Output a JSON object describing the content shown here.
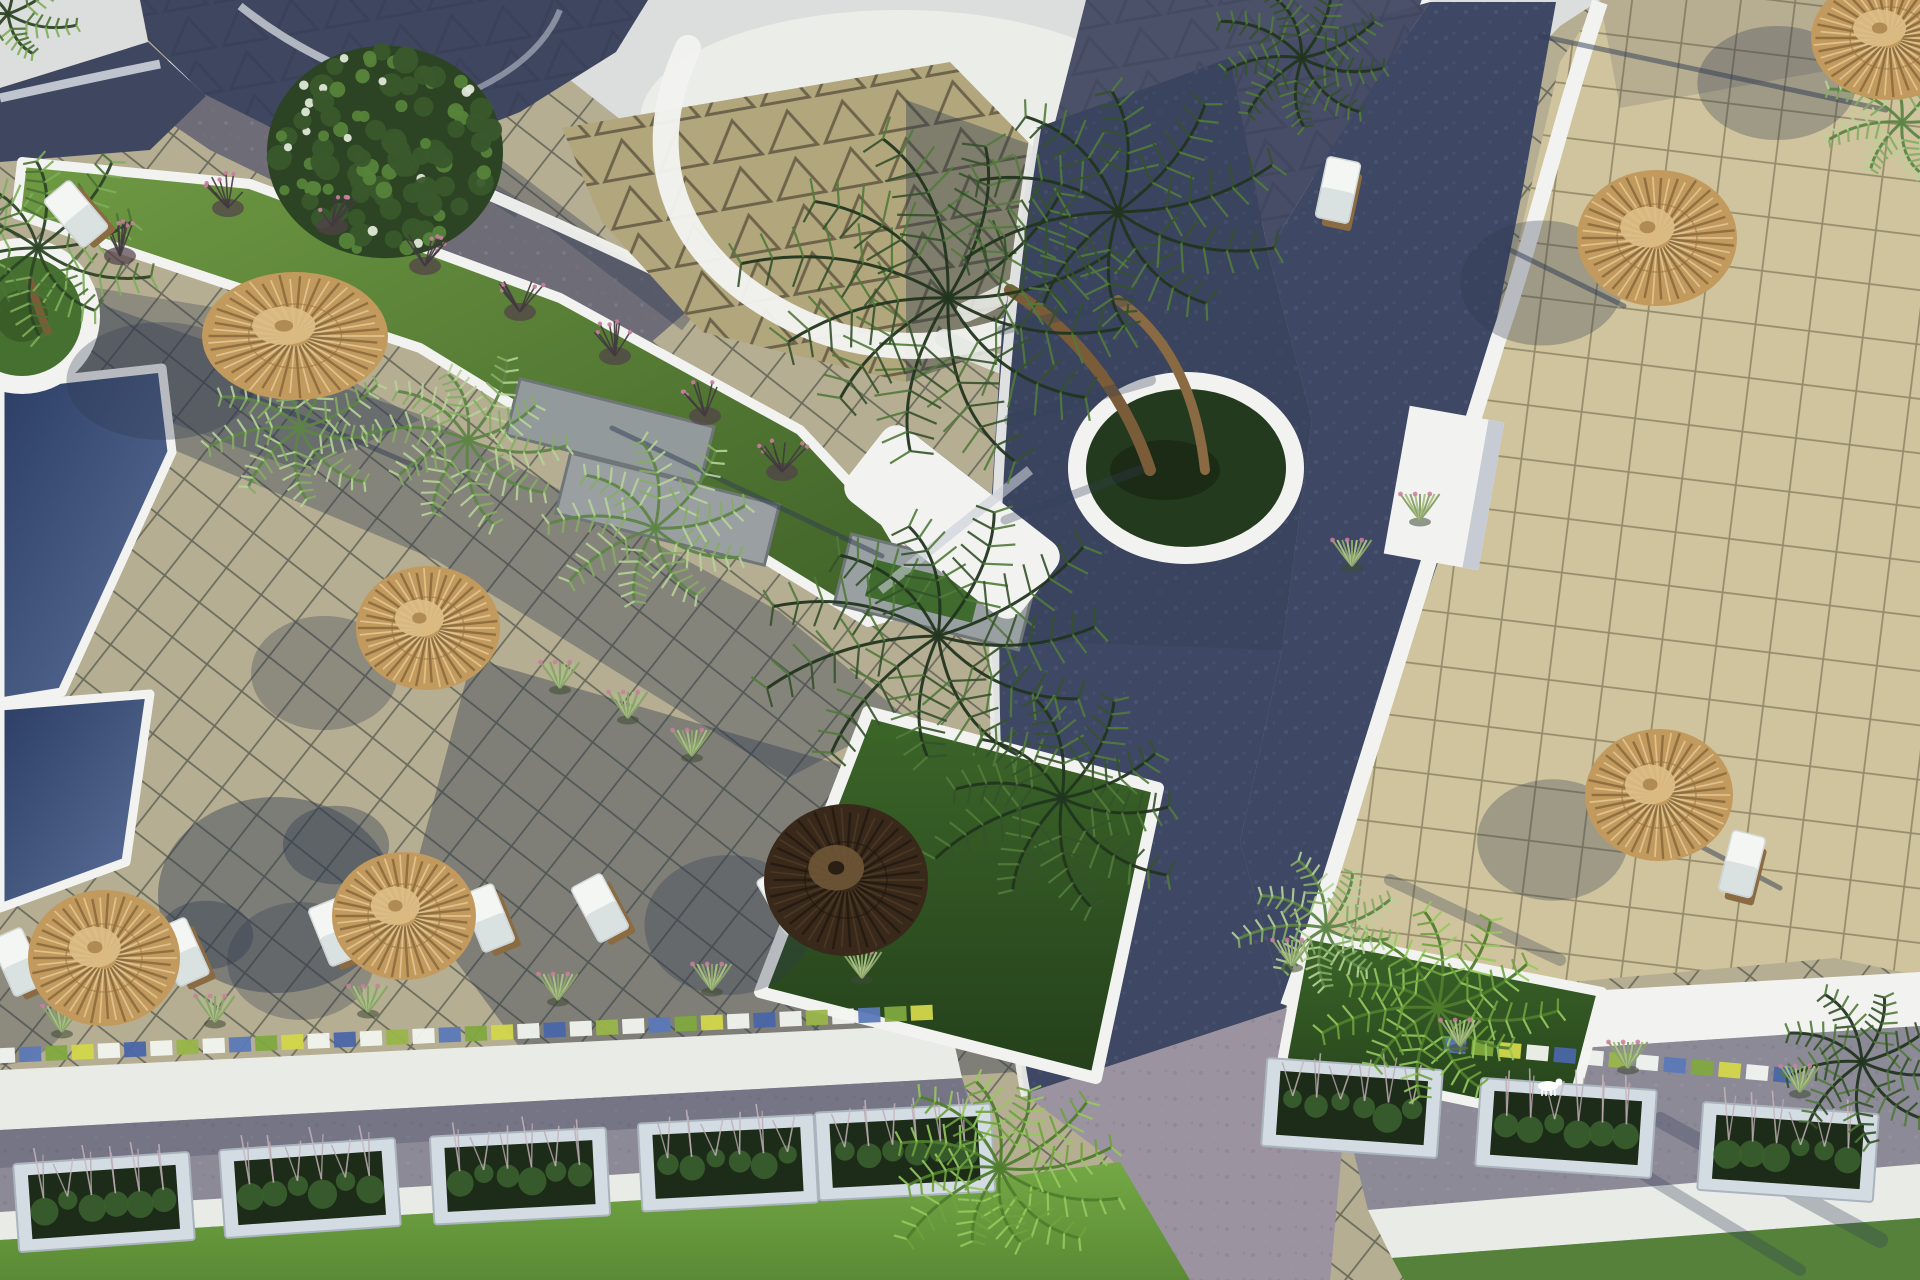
{
  "meta": {
    "description": "Top-down aerial 3D architectural rendering of a resort complex: tiled pool terraces with thatched parasols and white sun loungers, dark-blue swimming pools, cobbled pathways, curved white walls, grass planters with palm trees, and flower boxes along a lower promenade.",
    "view": "top-down aerial",
    "style": "photorealistic 3D render, afternoon sun casting long shadows to the lower-left"
  },
  "palette": {
    "beige_left": "#b6ae92",
    "grout_left": "#50544a",
    "beige_right": "#cfc49d",
    "grout_right": "#7d7557",
    "tri_tan": "#b2a67c",
    "tri_line": "#4e4533",
    "white": "#f2f3f0",
    "curb_white": "#e9ebe6",
    "off_white": "#e6e8e4",
    "sky_white": "#dcdedd",
    "roof_navy": "#3f4660",
    "roof_navy2": "#4a5168",
    "path_gray": "#6e6d77",
    "road": "#3e4864",
    "road_light": "#9b93a0",
    "cobble": "#8d8a97",
    "stone": "#939a9c",
    "stone_dark": "#6f7678",
    "shadow": "#2e3950",
    "grass_window": "#3f6b2e",
    "frame_light": "#d3dbe3",
    "box_green": "#1d2c18",
    "umbrella_thatch": "#c29a5e",
    "umbrella_thatch_light": "#ddbd85",
    "umbrella_spoke_dark": "#8a6a3c",
    "umbrella_spoke_light": "#e4c894",
    "umbrella_dark": "#39291b",
    "umbrella_dark_cap": "#6e5636",
    "trunk": "#7a5c38",
    "pink": "#c97f9d"
  },
  "scene": {
    "umbrellas": [
      {
        "cx": 295,
        "cy": 336,
        "rx": 93,
        "ry": 64,
        "kind": "thatch"
      },
      {
        "cx": 428,
        "cy": 628,
        "rx": 72,
        "ry": 62,
        "kind": "thatch"
      },
      {
        "cx": 104,
        "cy": 958,
        "rx": 76,
        "ry": 68,
        "kind": "thatch"
      },
      {
        "cx": 404,
        "cy": 916,
        "rx": 72,
        "ry": 64,
        "kind": "thatch"
      },
      {
        "cx": 846,
        "cy": 880,
        "rx": 82,
        "ry": 76,
        "kind": "dark"
      },
      {
        "cx": 1657,
        "cy": 238,
        "rx": 80,
        "ry": 68,
        "kind": "thatch"
      },
      {
        "cx": 1659,
        "cy": 795,
        "rx": 74,
        "ry": 66,
        "kind": "thatch"
      },
      {
        "cx": 1889,
        "cy": 38,
        "rx": 78,
        "ry": 62,
        "kind": "thatch"
      }
    ],
    "loungers": [
      {
        "cx": 18,
        "cy": 962,
        "rot": -24
      },
      {
        "cx": 182,
        "cy": 952,
        "rot": -24
      },
      {
        "cx": 335,
        "cy": 932,
        "rot": -22
      },
      {
        "cx": 488,
        "cy": 918,
        "rot": -22
      },
      {
        "cx": 600,
        "cy": 908,
        "rot": -28
      },
      {
        "cx": 786,
        "cy": 900,
        "rot": -30
      },
      {
        "cx": 1742,
        "cy": 864,
        "rot": 14
      },
      {
        "cx": 1338,
        "cy": 190,
        "rot": 12
      },
      {
        "cx": 76,
        "cy": 214,
        "rot": -40
      }
    ],
    "pools": [
      {
        "name": "pool-left-upper",
        "points": "0,386 162,368 172,452 62,692 0,702",
        "fill": "dark"
      },
      {
        "name": "pool-left-lower",
        "points": "0,706 150,694 126,862 0,908",
        "fill": "dark"
      },
      {
        "name": "pool-right-upper",
        "points": "1856,206 1920,194 1920,482 1868,482 1842,330",
        "fill": "light"
      },
      {
        "name": "pool-right-lower",
        "points": "1776,560 1920,546 1920,758 1806,734 1766,642",
        "fill": "dark"
      }
    ],
    "palms": [
      {
        "cx": 8,
        "cy": 14,
        "r": 72,
        "tone": "mixed",
        "fronds": 7,
        "rot": 0.2
      },
      {
        "cx": 38,
        "cy": 248,
        "r": 130,
        "tone": "mixed",
        "fronds": 10,
        "rot": 0.3
      },
      {
        "cx": 300,
        "cy": 428,
        "r": 95,
        "tone": "fern",
        "fronds": 9,
        "rot": 0.1
      },
      {
        "cx": 468,
        "cy": 440,
        "r": 105,
        "tone": "fern",
        "fronds": 10,
        "rot": 0.7
      },
      {
        "cx": 655,
        "cy": 528,
        "r": 110,
        "tone": "fern",
        "fronds": 9,
        "rot": 0.4
      },
      {
        "cx": 948,
        "cy": 298,
        "r": 225,
        "tone": "dark",
        "fronds": 12,
        "rot": 0.2
      },
      {
        "cx": 1118,
        "cy": 212,
        "r": 165,
        "tone": "dark",
        "fronds": 10,
        "rot": 0.9
      },
      {
        "cx": 938,
        "cy": 636,
        "r": 185,
        "tone": "dark",
        "fronds": 11,
        "rot": 0.5
      },
      {
        "cx": 1062,
        "cy": 798,
        "r": 145,
        "tone": "dark",
        "fronds": 10,
        "rot": 0.1
      },
      {
        "cx": 1000,
        "cy": 1168,
        "r": 125,
        "tone": "bright",
        "fronds": 12,
        "rot": 0.3
      },
      {
        "cx": 1438,
        "cy": 1008,
        "r": 118,
        "tone": "bright",
        "fronds": 11,
        "rot": 0.6
      },
      {
        "cx": 1326,
        "cy": 928,
        "r": 88,
        "tone": "fern",
        "fronds": 9,
        "rot": 0.2
      },
      {
        "cx": 1862,
        "cy": 1062,
        "r": 100,
        "tone": "dark",
        "fronds": 9,
        "rot": 0.8
      },
      {
        "cx": 1902,
        "cy": 122,
        "r": 85,
        "tone": "fern",
        "fronds": 8,
        "rot": 0.5
      },
      {
        "cx": 1302,
        "cy": 58,
        "r": 95,
        "tone": "dark",
        "fronds": 9,
        "rot": 0.15
      }
    ],
    "tree": {
      "cx": 385,
      "cy": 152,
      "r": 118
    },
    "tree_shadow": {
      "cx": 276,
      "cy": 895,
      "rx": 118,
      "ry": 98
    },
    "shrubs": [
      {
        "x": 332,
        "y": 222
      },
      {
        "x": 425,
        "y": 262
      },
      {
        "x": 520,
        "y": 308
      },
      {
        "x": 615,
        "y": 352
      },
      {
        "x": 705,
        "y": 412
      },
      {
        "x": 782,
        "y": 468
      },
      {
        "x": 120,
        "y": 252
      },
      {
        "x": 228,
        "y": 204
      }
    ],
    "tufts": [
      {
        "x": 62,
        "y": 1032
      },
      {
        "x": 215,
        "y": 1022
      },
      {
        "x": 368,
        "y": 1012
      },
      {
        "x": 558,
        "y": 1000
      },
      {
        "x": 712,
        "y": 990
      },
      {
        "x": 862,
        "y": 978
      },
      {
        "x": 628,
        "y": 718
      },
      {
        "x": 560,
        "y": 688
      },
      {
        "x": 692,
        "y": 756
      },
      {
        "x": 1292,
        "y": 966
      },
      {
        "x": 1460,
        "y": 1046
      },
      {
        "x": 1628,
        "y": 1068
      },
      {
        "x": 1800,
        "y": 1092
      },
      {
        "x": 1352,
        "y": 566
      },
      {
        "x": 1420,
        "y": 520
      }
    ],
    "pole_shadows": [
      {
        "x1": 1540,
        "y1": 36,
        "x2": 1886,
        "y2": 110
      },
      {
        "x1": 1506,
        "y1": 248,
        "x2": 1624,
        "y2": 306
      },
      {
        "x1": 612,
        "y1": 428,
        "x2": 882,
        "y2": 556
      },
      {
        "x1": 242,
        "y1": 392,
        "x2": 420,
        "y2": 468
      },
      {
        "x1": 1700,
        "y1": 846,
        "x2": 1780,
        "y2": 888
      }
    ],
    "frond_shadows": [
      {
        "x1": 1002,
        "y1": 330,
        "x2": 1130,
        "y2": 300,
        "w": 10
      },
      {
        "x1": 1010,
        "y1": 420,
        "x2": 1150,
        "y2": 380,
        "w": 12
      },
      {
        "x1": 1005,
        "y1": 520,
        "x2": 1140,
        "y2": 470,
        "w": 9
      },
      {
        "x1": 1660,
        "y1": 1120,
        "x2": 1880,
        "y2": 1240,
        "w": 16
      },
      {
        "x1": 1620,
        "y1": 1160,
        "x2": 1800,
        "y2": 1270,
        "w": 12
      },
      {
        "x1": 1390,
        "y1": 880,
        "x2": 1560,
        "y2": 960,
        "w": 12
      }
    ],
    "mosaic_strips": [
      {
        "x1": 4,
        "y1": 1056,
        "x2": 948,
        "y2": 1012
      },
      {
        "x1": 1455,
        "y1": 1046,
        "x2": 1812,
        "y2": 1078
      }
    ],
    "planter_boxes": [
      {
        "cx": 104,
        "cy": 1202,
        "rot": -4
      },
      {
        "cx": 310,
        "cy": 1188,
        "rot": -4
      },
      {
        "cx": 520,
        "cy": 1176,
        "rot": -3
      },
      {
        "cx": 728,
        "cy": 1163,
        "rot": -3
      },
      {
        "cx": 905,
        "cy": 1152,
        "rot": -3
      },
      {
        "cx": 1352,
        "cy": 1108,
        "rot": 4
      },
      {
        "cx": 1566,
        "cy": 1128,
        "rot": 4
      },
      {
        "cx": 1788,
        "cy": 1152,
        "rot": 4
      }
    ],
    "dog": {
      "x": 1548,
      "y": 1086
    }
  }
}
